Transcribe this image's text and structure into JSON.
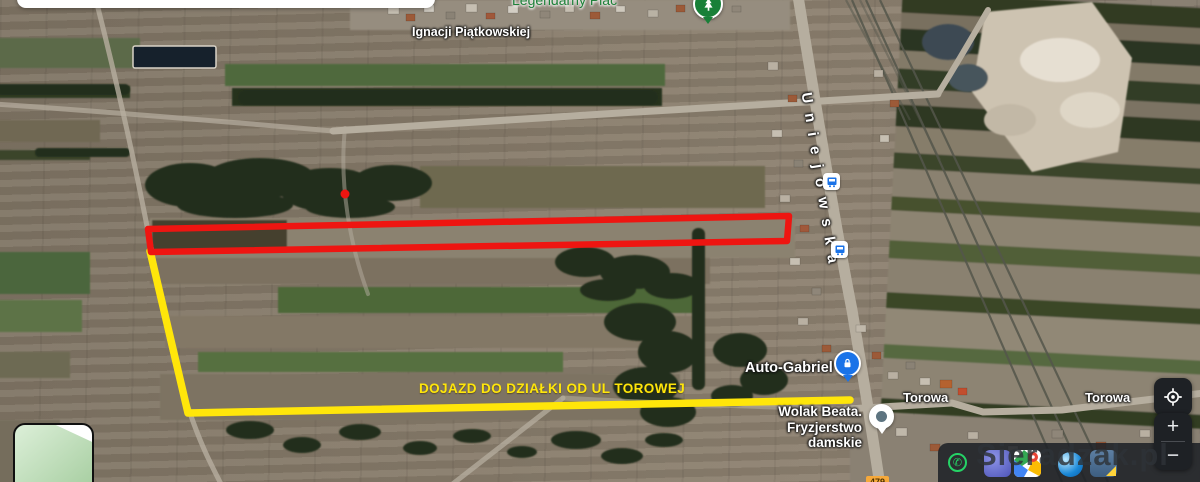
{
  "theme": {
    "annotation-red": "#ee1511",
    "route-yellow": "#ffe60a",
    "poi-green-text": "#1d8038",
    "park-pin-green": "#188038",
    "pin-blue": "#1a73e8",
    "label-white": "#ffffff",
    "control-bg": "#1e2125",
    "watermark-color": "#2e3338",
    "whatsapp-green": "#25d366",
    "shield-orange": "#f6a93b"
  },
  "map": {
    "labels": {
      "legendarny_plac": "Legendarny Plac",
      "ignacji_piatkowskiej": "Ignacji Piątkowskiej",
      "uniejowska": "Uniejowska",
      "auto_gabriel": "Auto-Gabriel",
      "wolak_line1": "Wolak Beata.",
      "wolak_line2": "Fryzjerstwo damskie",
      "torowa": "Torowa",
      "road_shield": "479"
    },
    "icons": {
      "park_pin": "tree-icon",
      "bus_stop": "bus-icon",
      "auto_gabriel_pin": "padlock-icon",
      "wolak_pin": "poi-dot-icon",
      "my_location": "crosshair-icon",
      "whatsapp": "phone-icon"
    }
  },
  "annotations": {
    "plot_outline": {
      "points": "148,229 789,216 787,241 151,252"
    },
    "red_dot": {
      "x": 345,
      "y": 194
    },
    "route": {
      "points": "150,251 188,413 850,400",
      "label": "DOJAZD DO DZIAŁKI OD UL TOROWEJ"
    }
  },
  "controls": {
    "zoom_in": "+",
    "zoom_out": "−"
  },
  "watermark": "Sieradzak.pl"
}
